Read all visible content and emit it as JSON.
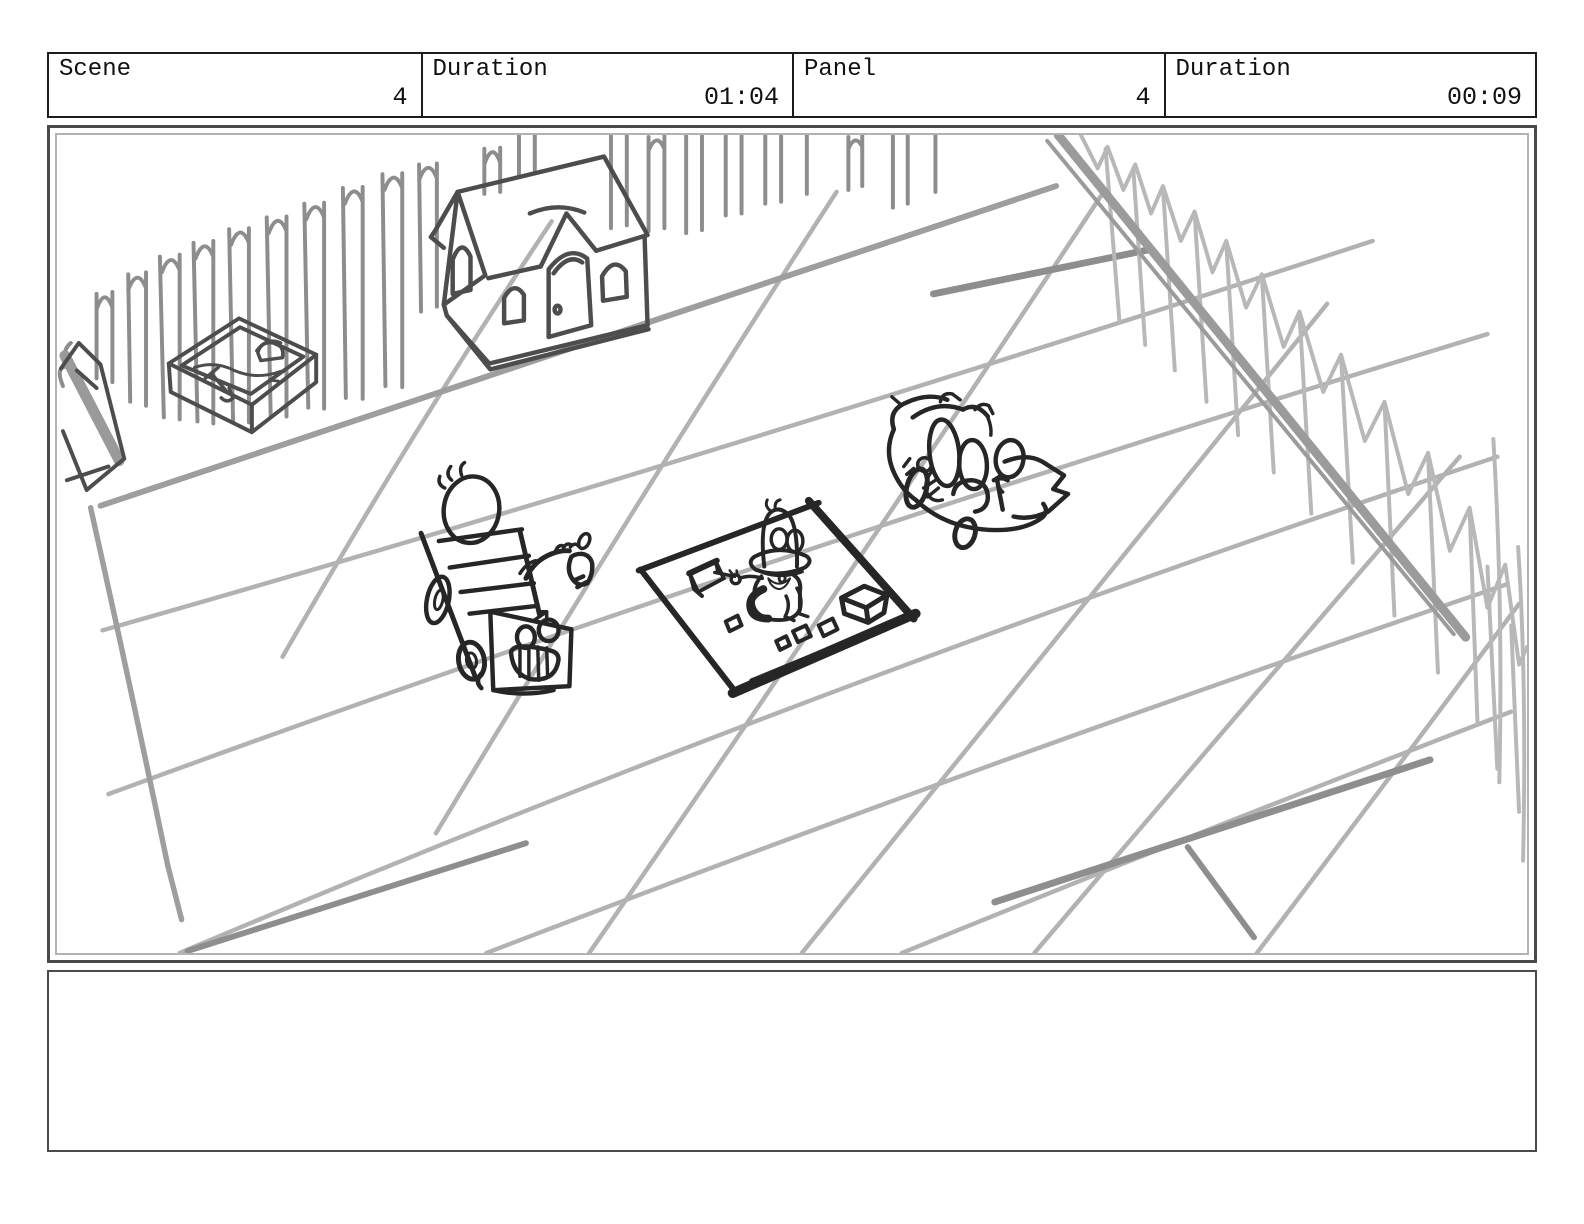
{
  "page": {
    "width": 1584,
    "height": 1224,
    "background": "#ffffff"
  },
  "header": {
    "cells": [
      {
        "id": "scene",
        "label": "Scene",
        "value": "4"
      },
      {
        "id": "scene-duration",
        "label": "Duration",
        "value": "01:04"
      },
      {
        "id": "panel",
        "label": "Panel",
        "value": "4"
      },
      {
        "id": "panel-duration",
        "label": "Duration",
        "value": "00:09"
      }
    ]
  },
  "panel": {
    "type": "storyboard-drawing",
    "description": "Rough pencil sketch of a backyard play area: picket fence along the back and down the right side, toy playhouse, sandbox with shovel and pail, perspective tiled patio grid, a child riding a smiling pony ride-on toy, a duck toy sitting on a dark-edged play mat with scattered blocks, and a toy car with oval-headed riders.",
    "colors": {
      "ink": "#262626",
      "house_line": "#4d4d4d",
      "fence_left": "#8d8d8d",
      "fence_right": "#b8b8b8",
      "grid_line": "#b2b2b2",
      "grid_accent": "#8e8e8e",
      "rail": "#9b9b9b",
      "paper": "#ffffff",
      "frame_outer": "#4a4a4a",
      "frame_inner": "#b3b3b3"
    }
  },
  "sketch": {
    "elements": [
      {
        "name": "picket-fence-left",
        "description": "hand-drawn picket fence receding along the back left"
      },
      {
        "name": "picket-fence-right",
        "description": "picket fence receding down the right side with a thick gray rail"
      },
      {
        "name": "corner-post",
        "description": "fence corner post and rail end at the left edge"
      },
      {
        "name": "patio-grid",
        "description": "light gray perspective grid of patio tiles with darker accent strokes"
      },
      {
        "name": "playhouse",
        "description": "toy playhouse with gabled roof, dormer, arched door and arched windows"
      },
      {
        "name": "sandbox",
        "description": "rectangular sandbox containing a toy shovel and pail"
      },
      {
        "name": "ride-on-toy",
        "description": "child with egg-shaped head seen from behind riding a smiling pony/train ride-on toy"
      },
      {
        "name": "duck-on-mat",
        "description": "duck toy with big eyes and wide bill sitting on a play mat with scattered toy blocks"
      },
      {
        "name": "toy-car",
        "description": "toy car seen from the rear with riders and a pointed rear wing"
      }
    ]
  },
  "notes": {
    "value": ""
  }
}
